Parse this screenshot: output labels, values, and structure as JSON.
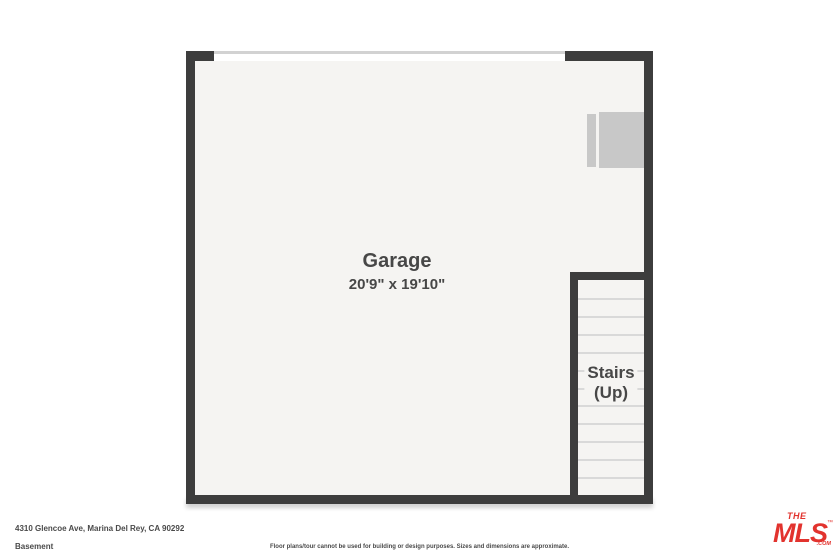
{
  "colors": {
    "wall": "#3d3d3d",
    "floor": "#f5f4f2",
    "tread": "#d9d9d9",
    "appliance": "#c8c8c8",
    "door": "#d2d2d2",
    "label": "#474747",
    "footer": "#4a4a4a",
    "red": "#e2332e"
  },
  "floorplan": {
    "room": {
      "name": "Garage",
      "dimensions": "20'9\" x 19'10\""
    },
    "stairs": {
      "label_line1": "Stairs",
      "label_line2": "(Up)",
      "tread_count": 11
    }
  },
  "footer": {
    "address": "4310 Glencoe Ave, Marina Del Rey, CA 90292",
    "floor_label": "Basement",
    "disclaimer": "Floor plans/tour cannot be used for building or design purposes. Sizes and dimensions are approximate."
  },
  "logo": {
    "the": "THE",
    "mls": "MLS",
    "tm": "™",
    "com": ".COM"
  }
}
